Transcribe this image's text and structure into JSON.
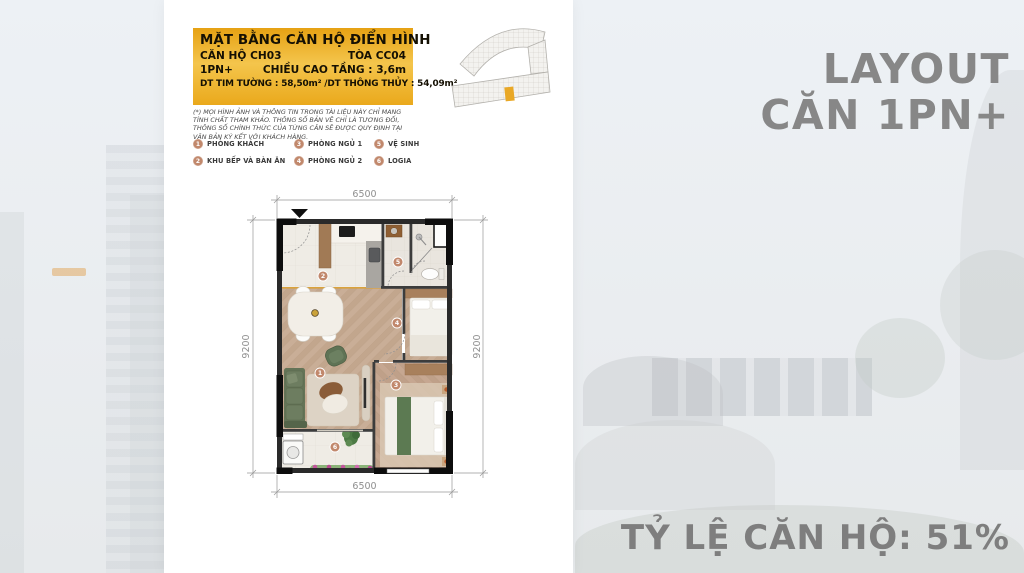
{
  "info_card": {
    "title": "MẶT BẰNG CĂN HỘ ĐIỂN HÌNH",
    "unit": "CĂN HỘ CH03",
    "tower": "TÒA CC04",
    "type": "1PN+",
    "ceiling": "CHIỀU CAO TẦNG : 3,6m",
    "area": "DT TIM TƯỜNG : 58,50m² /DT THÔNG THỦY : 54,09m²"
  },
  "disclaimer": "(*) MỌI HÌNH ẢNH VÀ THÔNG TIN TRONG TÀI LIỆU NÀY CHỈ MANG TÍNH CHẤT THAM KHẢO. THÔNG SỐ BẢN VẼ CHỈ LÀ TƯƠNG ĐỐI, THÔNG SỐ CHÍNH THỨC CỦA TỪNG CĂN SẼ ĐƯỢC QUY ĐỊNH TẠI VĂN BẢN KÝ KẾT VỚI KHÁCH HÀNG.",
  "legend": {
    "items": [
      {
        "num": "1",
        "label": "PHÒNG KHÁCH"
      },
      {
        "num": "2",
        "label": "KHU BẾP VÀ BÀN ĂN"
      },
      {
        "num": "3",
        "label": "PHÒNG NGỦ 1"
      },
      {
        "num": "4",
        "label": "PHÒNG NGỦ 2"
      },
      {
        "num": "5",
        "label": "VỆ SINH"
      },
      {
        "num": "6",
        "label": "LOGIA"
      }
    ]
  },
  "floor_plan": {
    "dimensions": {
      "top": "6500",
      "bottom": "6500",
      "left": "9200",
      "right": "9200"
    }
  },
  "headings": {
    "title_line1": "LAYOUT",
    "title_line2": "CĂN 1PN+",
    "ratio": "TỶ LỆ CĂN HỘ: 51%"
  },
  "colors": {
    "gold": "#EBA81C",
    "badge": "#C1886C",
    "heading_gray": "#878787",
    "highlight_unit": "#E9A826"
  }
}
